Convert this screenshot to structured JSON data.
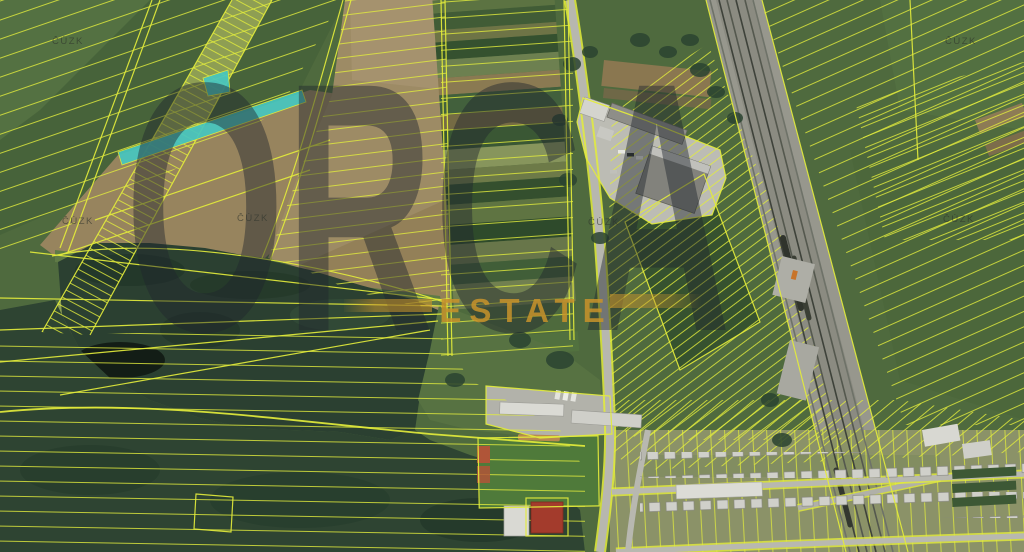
{
  "watermarks": {
    "provider": "ČÚZK",
    "brand_top": "ORCA",
    "brand_bottom": "ESTATE"
  },
  "map": {
    "type": "cadastral-orthophoto",
    "overlay": "parcel-boundaries",
    "highlighted_parcel_present": true
  },
  "colors": {
    "parcel_line": "#e3ec3b",
    "highlight_parcel": "#47c7c0",
    "field_green": "#4f6a3e",
    "field_dark_green": "#3a5532",
    "field_tan": "#9c8a64",
    "forest_dark": "#2e4432",
    "water_dark": "#2b4031",
    "road_gray": "#b7b7af",
    "rail_gray": "#97978d",
    "building_gray": "#8c8c86",
    "building_white": "#d8d8d2",
    "roof_red": "#a33b2c",
    "brand_dark": "#20262e",
    "brand_gold": "#c8932b",
    "provider_text": "#2e332c"
  }
}
